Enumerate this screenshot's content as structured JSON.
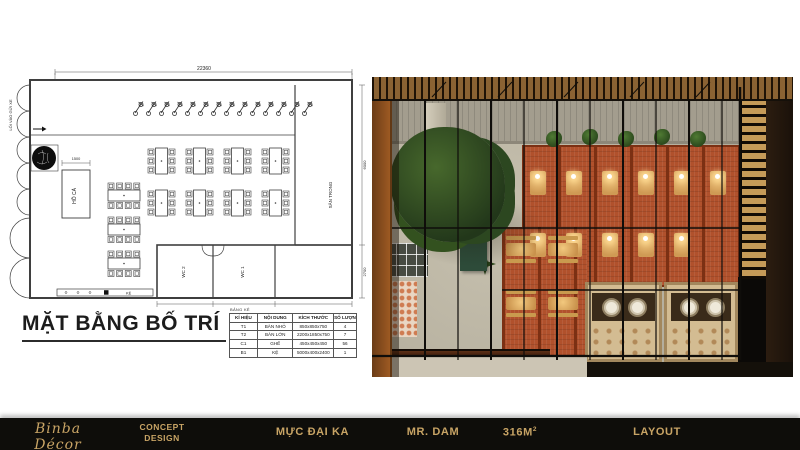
{
  "theme": {
    "gold": "#c8a465",
    "footer_bg": "#0e0d0a",
    "plan_line": "#3f3f3f",
    "brick": "#b1512c",
    "foliage": "#2f4b20"
  },
  "floor_plan": {
    "title": "MẶT BẰNG BỐ TRÍ",
    "legend_title": "BẢNG KÊ",
    "labels": {
      "fish_pond": "HỒ CÁ",
      "courtyard": "SÂN TRONG",
      "wc1": "WC 1",
      "wc2": "WC 2",
      "shelf": "KỆ",
      "entrance": "LỐI VÀO GỬI XE"
    },
    "dimensions": {
      "total_width": "22360",
      "pond_width": "1500",
      "right_upper": "6000",
      "right_lower": "2700"
    },
    "legend": {
      "headers": [
        "KÍ HIỆU",
        "NỘI DUNG",
        "KÍCH THƯỚC",
        "SỐ LƯỢNG"
      ],
      "rows": [
        {
          "code": "T1",
          "item": "BÀN NHỎ",
          "size": "850x850x750",
          "qty": "4"
        },
        {
          "code": "T2",
          "item": "BÀN LỚN",
          "size": "2200x1850x750",
          "qty": "7"
        },
        {
          "code": "C1",
          "item": "GHẾ",
          "size": "450x450x450",
          "qty": "56"
        },
        {
          "code": "B1",
          "item": "KỆ",
          "size": "5000x400x2400",
          "qty": "1"
        }
      ]
    }
  },
  "footer": {
    "logo_text": "Binba Décor",
    "logo_tagline": "DESIGN FOR LIFE",
    "concept_line1": "CONCEPT",
    "concept_line2": "DESIGN",
    "project": "MỰC ĐẠI KA",
    "client": "MR. DAM",
    "area_value": "316M",
    "area_sup": "2",
    "stage": "LAYOUT"
  }
}
